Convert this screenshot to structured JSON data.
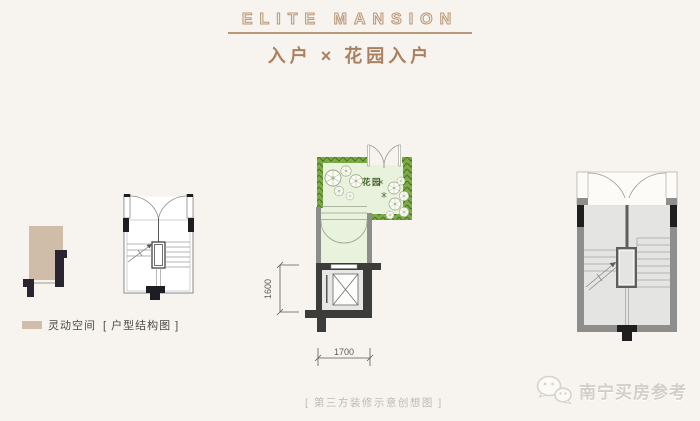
{
  "header": {
    "brand": "ELITE MANSION",
    "title": "入户 × 花园入户"
  },
  "legend": {
    "flex_space": "灵动空间",
    "structure": "[ 户型结构图 ]"
  },
  "garden_plan": {
    "garden_label": "花园",
    "height_dim": "1600",
    "width_dim": "1700"
  },
  "footer": {
    "caption": "[ 第三方装修示意创想图 ]",
    "watermark": "南宁买房参考"
  },
  "colors": {
    "background": "#f7f4ef",
    "brand_tan": "#bb9878",
    "title_brown": "#ab8061",
    "flex_space_beige": "#cfbda9",
    "hedge_green": "#7cab45",
    "hedge_dark": "#46701f",
    "garden_light_green": "#e9f2dc",
    "wall_dark": "#2a2531",
    "wall_gray": "#8d8d8b",
    "dim_gray": "#5b5b59"
  }
}
